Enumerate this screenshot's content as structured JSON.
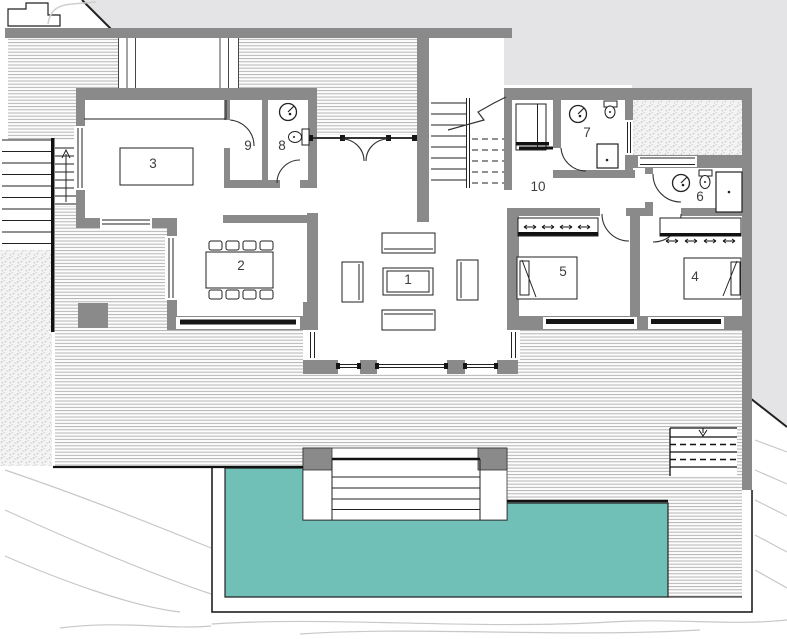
{
  "plan": {
    "type": "architectural-floor-plan",
    "rooms": [
      {
        "label": "1"
      },
      {
        "label": "2"
      },
      {
        "label": "3"
      },
      {
        "label": "4"
      },
      {
        "label": "5"
      },
      {
        "label": "6"
      },
      {
        "label": "7"
      },
      {
        "label": "8"
      },
      {
        "label": "9"
      },
      {
        "label": "10"
      }
    ],
    "colors": {
      "pool": "#71c0b8",
      "wall": "#8a8a8a",
      "site": "#e4e4e6",
      "hatch_line": "#adadad",
      "outline": "#222222",
      "contour": "#c8c8c8"
    }
  }
}
